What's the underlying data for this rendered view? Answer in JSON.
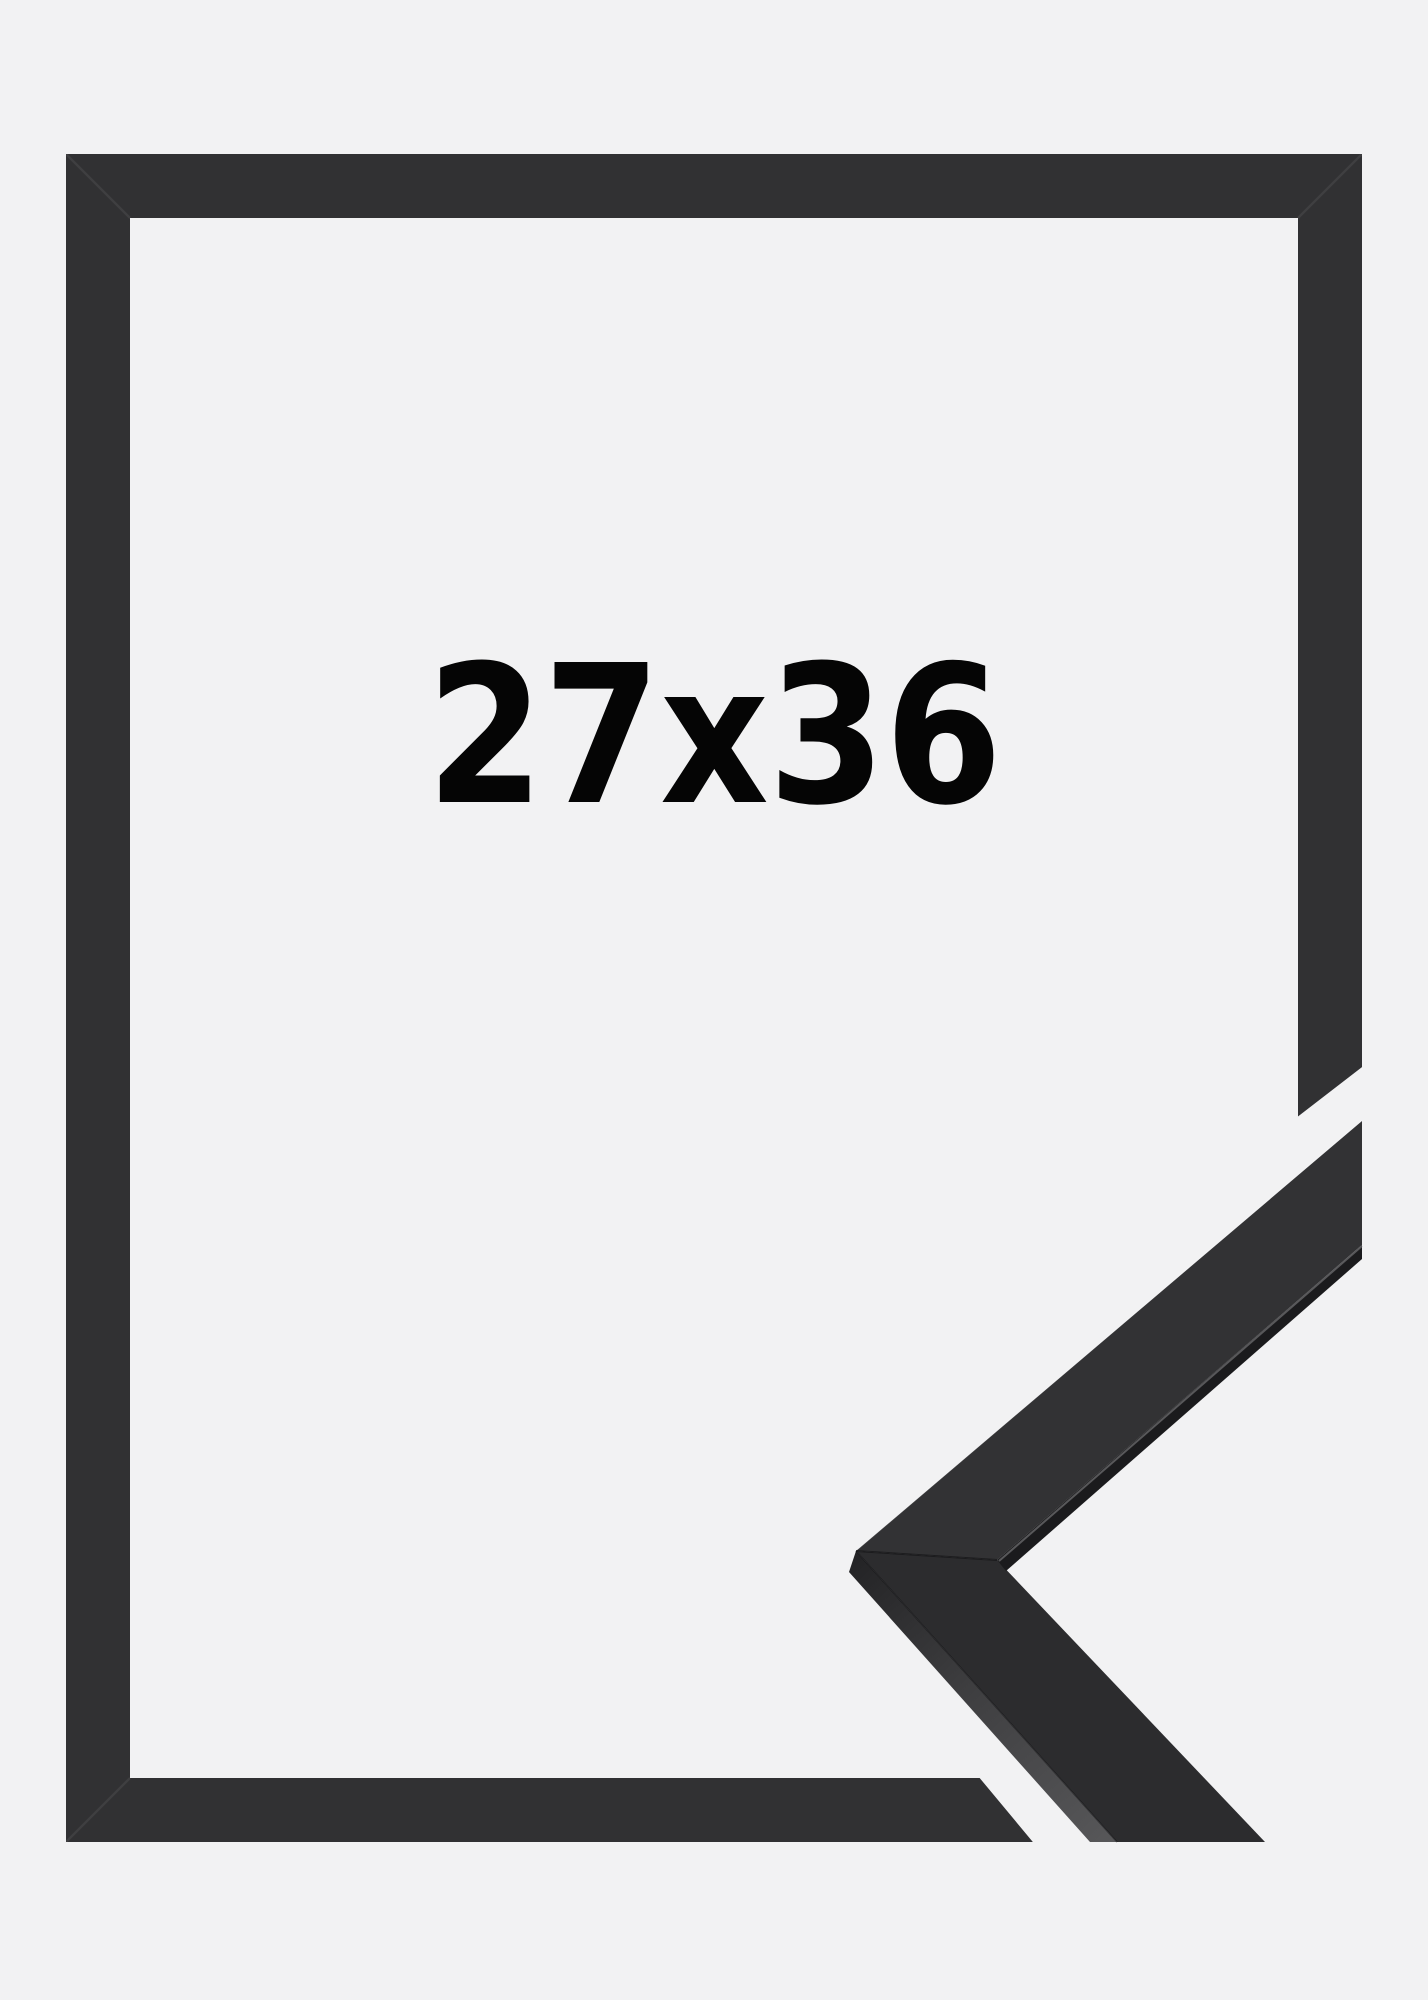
{
  "product": {
    "size_label": "27x36"
  },
  "colors": {
    "background": "#f2f2f3",
    "frame_black": "#313133",
    "profile_face_upper": "#323234",
    "profile_face_lower": "#2c2c2e",
    "profile_inner_band": "#1b1b1d",
    "profile_side_dark": "#242426",
    "profile_side_light": "#575759",
    "label_text": "#050505"
  }
}
